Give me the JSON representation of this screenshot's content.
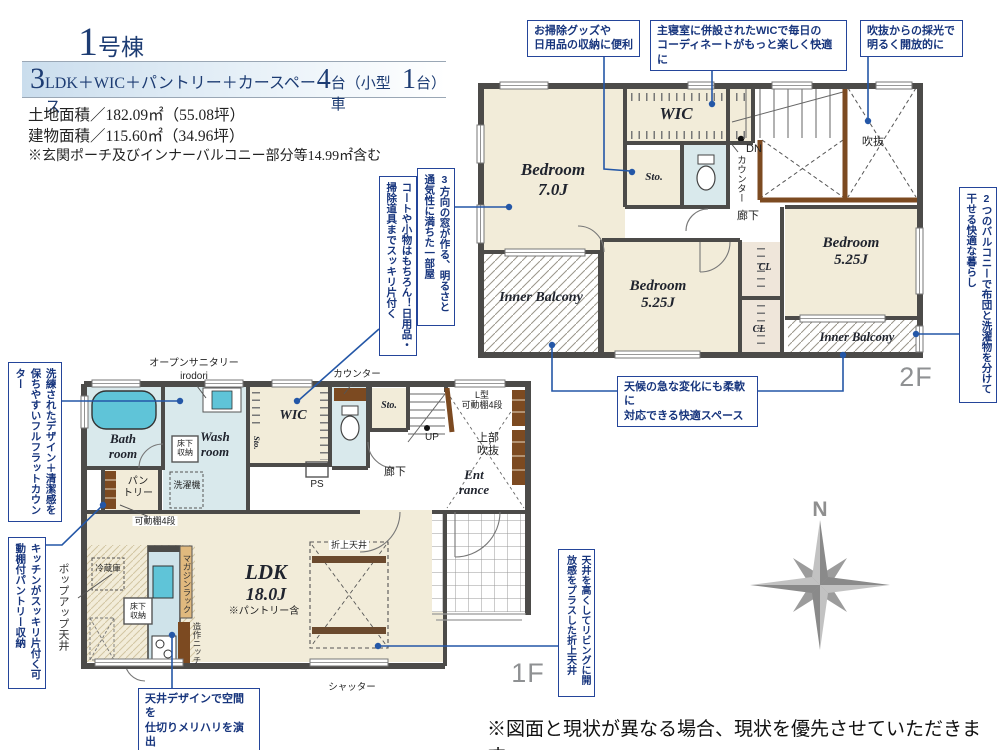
{
  "header": {
    "building": {
      "number": "1",
      "unit": "号棟"
    },
    "plan": {
      "p1": "3",
      "p2": "LDK＋WIC＋パントリー＋カースペース",
      "p3": "4",
      "p4": "台（小型車",
      "p5": "1",
      "p6": "台）"
    },
    "land_area": "土地面積／182.09㎡（55.08坪）",
    "building_area": "建物面積／115.60㎡（34.96坪）",
    "area_note": "※玄関ポーチ及びインナーバルコニー部分等14.99㎡含む"
  },
  "callouts": {
    "cleaning": "お掃除グッズや\n日用品の収納に便利",
    "wic_master": "主寝室に併設されたWICで毎日の\nコーディネートがもっと楽しく快適に",
    "void_light": "吹抜からの採光で\n明るく開放的に",
    "balconies": "2つのバルコニーで布団と洗濯物を分けて干せる快適な暮らし",
    "windows3": "3方向の窓が作る、明るさと通気性に満ちた一部屋",
    "coats": "コートや小物はもちろん！日用品・掃除道具までスッキリ片付く",
    "flat_counter": "洗練されたデザイン＋清潔感を保ちやすいフルフラットカウンター",
    "pantry_shelf": "キッチンがスッキリ片付く可動棚付パントリー収納",
    "weather": "天候の急な変化にも柔軟に\n対応できる快適スペース",
    "ceiling_design": "天井デザインで空間を\n仕切りメリハリを演出",
    "coved_ceiling": "天井を高くしてリビングに開放感をプラスした折上天井"
  },
  "floor2": {
    "floor_label": "2F",
    "bedroom_main_name": "Bedroom",
    "bedroom_main_size": "7.0J",
    "wic": "WIC",
    "sto": "Sto.",
    "dn": "DN",
    "counter": "カウンター",
    "hallway": "廊下",
    "void_label": "吹抜",
    "bedroom_center_name": "Bedroom",
    "bedroom_center_size": "5.25J",
    "bedroom_right_name": "Bedroom",
    "bedroom_right_size": "5.25J",
    "cl_top": "CL",
    "cl_bottom": "CL",
    "inner_balcony_left": "Inner Balcony",
    "inner_balcony_right": "Inner Balcony"
  },
  "floor1": {
    "floor_label": "1F",
    "open_sanitary": "オープンサニタリー",
    "open_sanitary_sub": "irodori",
    "bath": "Bath\nroom",
    "wash": "Wash\nroom",
    "underfloor_wash": "床下\n収納",
    "washer": "洗濯機",
    "pantry": "パン\nトリー",
    "shelf4": "可動棚4段",
    "wic": "WIC",
    "sto_a": "Sto.",
    "counter": "カウンター",
    "ps": "PS",
    "hallway": "廊下",
    "sto_b": "Sto.",
    "up": "UP",
    "l_shelf": "L型\n可動棚4段",
    "upper_void": "上部\n吹抜",
    "entrance": "Ent\nrance",
    "fridge": "冷蔵庫",
    "underfloor_kitchen": "床下\n収納",
    "magazine": "マガジンラック",
    "niche": "造作ニッチ",
    "ldk": "LDK",
    "ldk_size": "18.0J",
    "ldk_note": "※パントリー含",
    "coved": "折上天井",
    "shutter": "シャッター",
    "popup": "ポップアップ天井"
  },
  "compass": {
    "north": "N"
  },
  "disclaimer": "※図面と現状が異なる場合、現状を優先させていただきます。",
  "colors": {
    "accent": "#1d3c73",
    "leader": "#2457a7",
    "wall": "#4c4b49",
    "room_cream": "#f2ecd9",
    "room_blue": "#d9e9ec"
  }
}
